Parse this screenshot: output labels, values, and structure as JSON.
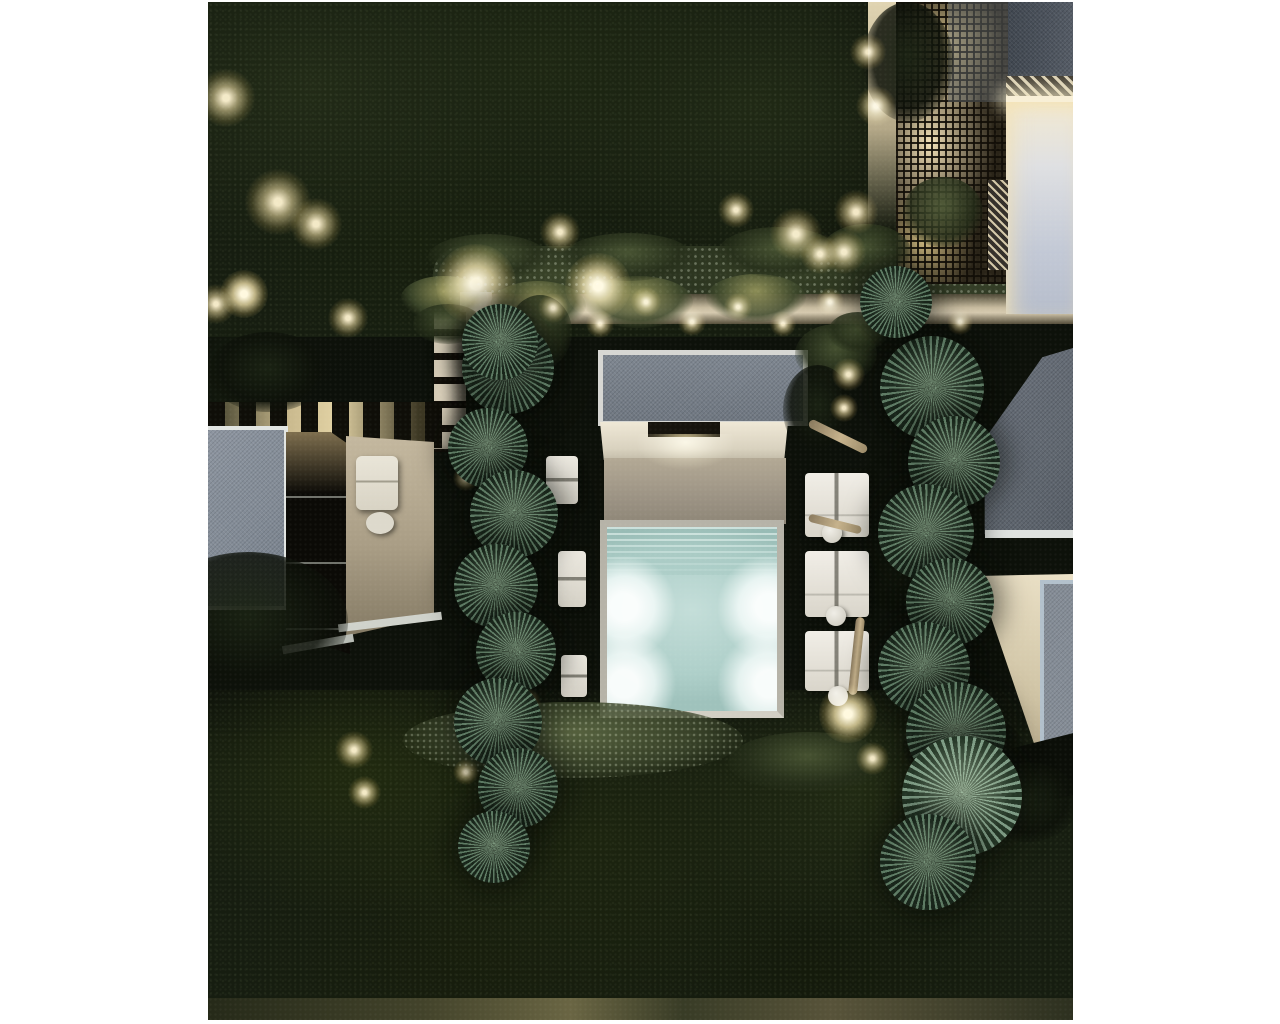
{
  "meta": {
    "description": "Aerial night-time architectural rendering of a modern villa garden: illuminated square swimming pool with cover slats and four underwater lights, flat-roof pool house, rows of white sun loungers with round side tables, two columns of round palm trees, surrounding buildings with gray gravel flat roofs, a back-lit lattice facade, garden walls, slatted walkways and warm landscape up-lights amid dense dark tree canopy.",
    "time_of_day": "night",
    "view": "top-down aerial"
  },
  "palette": {
    "page": "#ffffff",
    "ground": "#10140c",
    "midground": "#0d110a",
    "canopy": "#161d10",
    "water": "#b4d4cf",
    "pool_glow": "#f2fdf8",
    "warm_light": "#f4deA0",
    "beige_wall": "#cdc2a8",
    "roof_gray": "#7e8690",
    "roof_dark": "#4b525c",
    "white_trim": "#e2e5e2",
    "lavender_wall": "#c3c9d6",
    "skylight_frame": "#b3c1cc",
    "palm_green": "#5d7a63",
    "hedge_green": "#38402b"
  },
  "scene": {
    "palms": [
      [
        300,
        366,
        46,
        "std"
      ],
      [
        280,
        446,
        40,
        "std"
      ],
      [
        306,
        512,
        44,
        "std"
      ],
      [
        288,
        584,
        42,
        "std"
      ],
      [
        308,
        650,
        40,
        "std"
      ],
      [
        290,
        720,
        44,
        "std"
      ],
      [
        310,
        786,
        40,
        "std"
      ],
      [
        286,
        845,
        36,
        "std"
      ],
      [
        292,
        340,
        38,
        "std"
      ],
      [
        724,
        386,
        52,
        "std"
      ],
      [
        746,
        460,
        46,
        "std"
      ],
      [
        718,
        530,
        48,
        "std"
      ],
      [
        742,
        600,
        44,
        "std"
      ],
      [
        716,
        666,
        46,
        "std"
      ],
      [
        748,
        730,
        50,
        "std"
      ],
      [
        754,
        794,
        60,
        "fan"
      ],
      [
        720,
        860,
        48,
        "std"
      ],
      [
        688,
        300,
        36,
        "std"
      ]
    ],
    "lights": [
      [
        18,
        96,
        26,
        1
      ],
      [
        70,
        200,
        30,
        1
      ],
      [
        108,
        222,
        24,
        1
      ],
      [
        36,
        292,
        22,
        2
      ],
      [
        8,
        302,
        18,
        1
      ],
      [
        140,
        316,
        18,
        1
      ],
      [
        268,
        282,
        36,
        2
      ],
      [
        352,
        230,
        18,
        1
      ],
      [
        390,
        284,
        30,
        2
      ],
      [
        528,
        208,
        16,
        1
      ],
      [
        588,
        232,
        24,
        1
      ],
      [
        612,
        252,
        18,
        1
      ],
      [
        660,
        50,
        16,
        1
      ],
      [
        668,
        104,
        18,
        1
      ],
      [
        648,
        210,
        20,
        1
      ],
      [
        636,
        250,
        20,
        1
      ],
      [
        300,
        318,
        15,
        1
      ],
      [
        345,
        306,
        14,
        1
      ],
      [
        392,
        322,
        13,
        1
      ],
      [
        438,
        300,
        14,
        1
      ],
      [
        484,
        320,
        13,
        1
      ],
      [
        530,
        305,
        13,
        1
      ],
      [
        575,
        322,
        12,
        1
      ],
      [
        622,
        300,
        13,
        1
      ],
      [
        708,
        305,
        13,
        1
      ],
      [
        752,
        320,
        12,
        1
      ],
      [
        640,
        372,
        15,
        1
      ],
      [
        636,
        406,
        13,
        1
      ],
      [
        700,
        372,
        14,
        1
      ],
      [
        258,
        476,
        12,
        1
      ],
      [
        318,
        700,
        14,
        1
      ],
      [
        258,
        770,
        12,
        1
      ],
      [
        146,
        748,
        17,
        1
      ],
      [
        156,
        790,
        15,
        1
      ],
      [
        640,
        712,
        26,
        2
      ],
      [
        664,
        756,
        15,
        1
      ]
    ],
    "loungers_right": [
      [
        597,
        471,
        64,
        64
      ],
      [
        597,
        549,
        64,
        66
      ],
      [
        597,
        629,
        64,
        60
      ]
    ],
    "loungers_left": [
      [
        338,
        454,
        32,
        48
      ],
      [
        350,
        549,
        28,
        56
      ],
      [
        353,
        653,
        26,
        42
      ]
    ],
    "side_tables": [
      [
        624,
        531,
        10
      ],
      [
        628,
        614,
        10
      ],
      [
        630,
        694,
        10
      ]
    ],
    "trunks": [
      {
        "x": 598,
        "y": 430,
        "w": 64,
        "h": 9,
        "rot": 26
      },
      {
        "x": 600,
        "y": 518,
        "w": 54,
        "h": 8,
        "rot": 14
      },
      {
        "x": 644,
        "y": 615,
        "w": 9,
        "h": 78,
        "rot": 6
      }
    ],
    "bushes": [
      [
        193,
        274,
        86,
        44,
        "lit"
      ],
      [
        282,
        279,
        96,
        50,
        "lit"
      ],
      [
        255,
        312,
        90,
        40,
        "dark"
      ],
      [
        375,
        274,
        110,
        52,
        "lit"
      ],
      [
        498,
        272,
        100,
        48,
        "lit"
      ],
      [
        300,
        293,
        64,
        74,
        "mid"
      ],
      [
        587,
        322,
        82,
        60,
        "mid"
      ],
      [
        575,
        363,
        70,
        90,
        "dark"
      ],
      [
        205,
        302,
        70,
        40,
        "mid"
      ],
      [
        613,
        222,
        90,
        56,
        "mid"
      ],
      [
        510,
        225,
        120,
        50,
        "mid"
      ],
      [
        355,
        231,
        130,
        48,
        "mid"
      ],
      [
        220,
        232,
        120,
        46,
        "mid"
      ],
      [
        655,
        500,
        90,
        120,
        "dark"
      ],
      [
        195,
        700,
        340,
        76,
        "lit2"
      ],
      [
        -60,
        550,
        200,
        140,
        "dark"
      ],
      [
        620,
        310,
        60,
        40,
        "mid"
      ],
      [
        695,
        710,
        120,
        70,
        "dark"
      ],
      [
        770,
        760,
        100,
        80,
        "dark"
      ],
      [
        655,
        0,
        90,
        120,
        "dark"
      ],
      [
        695,
        175,
        80,
        70,
        "mid"
      ],
      [
        0,
        330,
        120,
        80,
        "dark"
      ],
      [
        520,
        730,
        160,
        60,
        "mid"
      ]
    ],
    "pool": {
      "orbs": [
        [
          17,
          80
        ],
        [
          162,
          80
        ],
        [
          17,
          157
        ],
        [
          162,
          157
        ]
      ],
      "orb_radius": 54
    }
  }
}
